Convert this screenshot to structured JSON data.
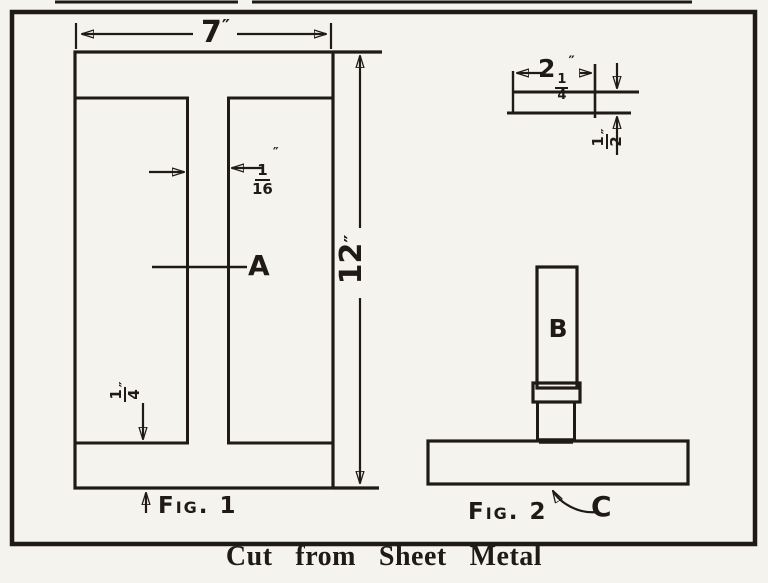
{
  "caption": "Cut from Sheet Metal",
  "fig1": {
    "name": "Fig. 1",
    "web_label": "A",
    "width_dim": {
      "value": "7",
      "unit": "″"
    },
    "height_dim": {
      "value": "12",
      "unit": "″"
    },
    "web_thickness_dim": {
      "num": "1",
      "den": "16",
      "unit": "″"
    },
    "flange_dim": {
      "num": "1",
      "den": "4",
      "unit": "″"
    }
  },
  "fig2": {
    "name": "Fig. 2",
    "bar_label": "B",
    "base_label": "C"
  },
  "strip": {
    "length_dim": {
      "whole": "2",
      "num": "1",
      "den": "4",
      "unit": "″"
    },
    "thickness_dim": {
      "num": "1",
      "den": "2",
      "unit": "″"
    }
  }
}
